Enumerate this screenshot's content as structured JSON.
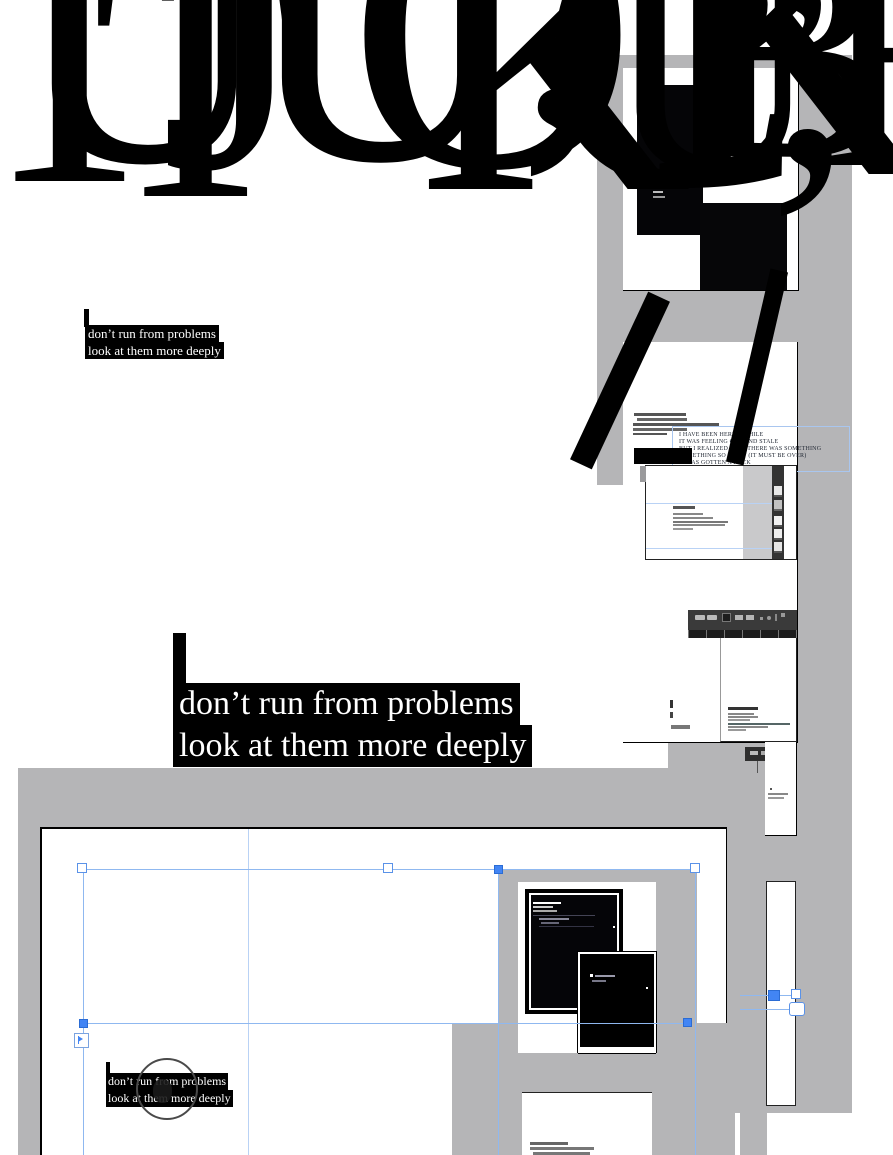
{
  "poem": {
    "line1": "don’t run from problems",
    "line2": "look at them more deeply"
  },
  "typed_poem": {
    "line1": "I HAVE BEEN HERE A WHILE",
    "line2": "IT WAS FEELING OLD AND STALE",
    "line3": "BUT I REALIZED THAT THERE WAS SOMETHING",
    "line4": "SOMETHING SO SHINY (IT MUST BE OVER)",
    "line5": "IT HAS GOTTEN A ROCK"
  },
  "giant_glyphs": [
    {
      "ch": "T"
    },
    {
      "ch": "U"
    },
    {
      "ch": "T"
    },
    {
      "ch": "J"
    },
    {
      "ch": "U"
    },
    {
      "ch": "O"
    },
    {
      "ch": "K"
    },
    {
      "ch": ","
    },
    {
      "ch": "C"
    },
    {
      "ch": "U"
    },
    {
      "ch": "K"
    },
    {
      "ch": "B"
    },
    {
      "ch": "”"
    },
    {
      "ch": ","
    },
    {
      "ch": "E"
    }
  ],
  "colors": {
    "pasteboard_gray": "#b5b5b7",
    "selection_blue": "#4285f4",
    "guide_blue": "#8fb8f0",
    "text_box_black": "#000000",
    "text_white": "#ffffff"
  }
}
